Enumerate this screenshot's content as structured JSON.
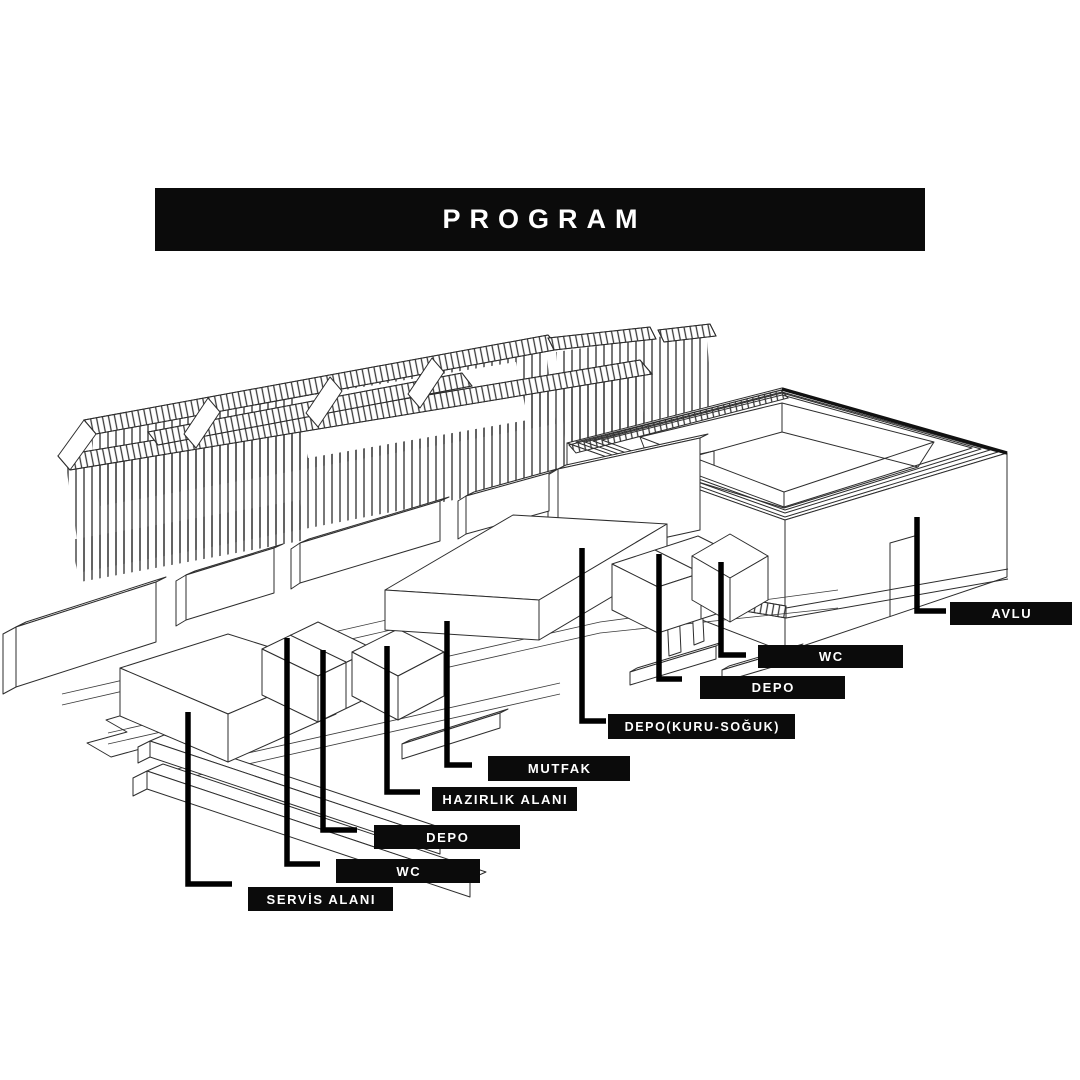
{
  "window": {
    "background": "#ffffff"
  },
  "banner": {
    "title": "PROGRAM",
    "background": "#0b0b0b",
    "text_color": "#ffffff"
  },
  "label_style": {
    "background": "#0b0b0b",
    "text_color": "#ffffff"
  },
  "labels": [
    {
      "id": "avlu",
      "text": "AVLU"
    },
    {
      "id": "wc-right",
      "text": "WC"
    },
    {
      "id": "depo-right",
      "text": "DEPO"
    },
    {
      "id": "depo-kuru-soguk",
      "text": "DEPO(KURU-SOĞUK)"
    },
    {
      "id": "mutfak",
      "text": "MUTFAK"
    },
    {
      "id": "hazirlik-alani",
      "text": "HAZIRLIK ALANI"
    },
    {
      "id": "depo-left",
      "text": "DEPO"
    },
    {
      "id": "wc-left",
      "text": "WC"
    },
    {
      "id": "servis-alani",
      "text": "SERVİS ALANI"
    }
  ],
  "diagram": {
    "line_color": "#2d2d2d",
    "leader_color": "#000000",
    "parts": [
      "pergola-canopy",
      "courtyard-building",
      "program-boxes",
      "wall-slabs",
      "ground-platform"
    ]
  }
}
